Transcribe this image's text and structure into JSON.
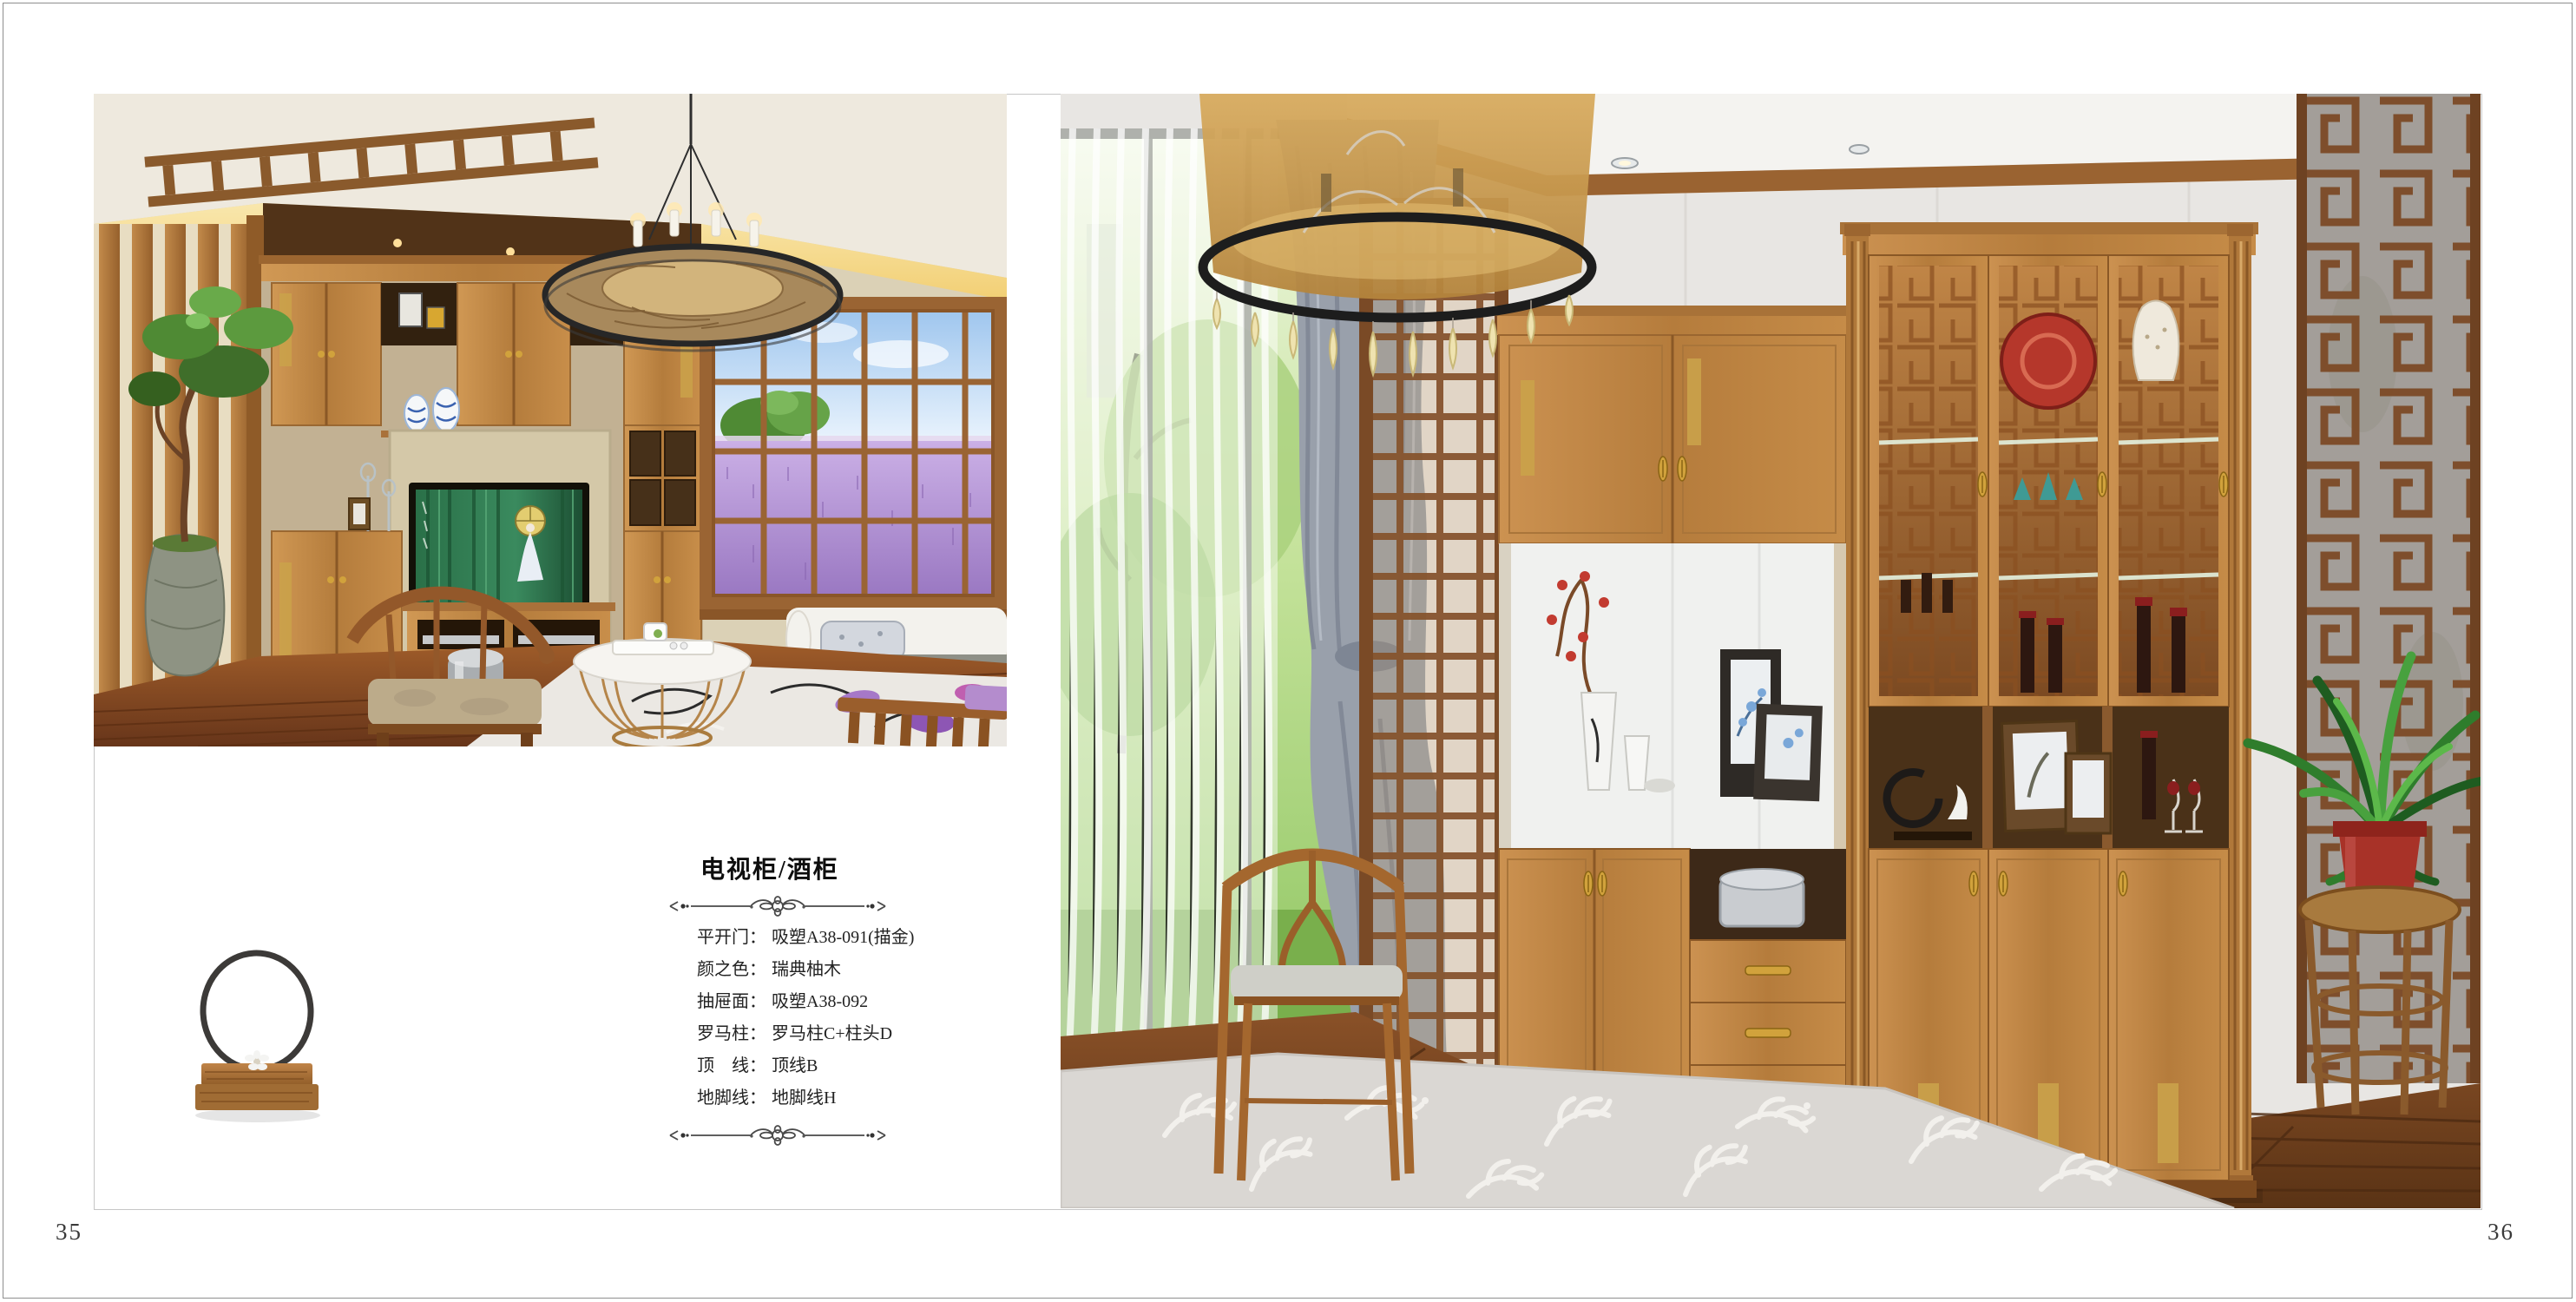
{
  "page": {
    "left_number": "35",
    "right_number": "36"
  },
  "product_info": {
    "title": "电视柜/酒柜",
    "specs": [
      {
        "label": "平开门：",
        "value": "吸塑A38-091(描金)"
      },
      {
        "label": "颜之色：",
        "value": "瑞典柚木"
      },
      {
        "label": "抽屉面：",
        "value": "吸塑A38-092"
      },
      {
        "label": "罗马柱：",
        "value": "罗马柱C+柱头D"
      },
      {
        "label": "顶　线：",
        "value": "顶线B"
      },
      {
        "label": "地脚线：",
        "value": "地脚线H"
      }
    ]
  },
  "photos": {
    "left_alt": "TV cabinet living-room scene",
    "right_alt": "Wine cabinet living-room scene",
    "decor_alt": "Ring ornament on wood base"
  },
  "colors": {
    "wood": "#bf8548",
    "wood_dark": "#8f5c28",
    "floor": "#7a4322",
    "accent_gold": "#caa24a",
    "lavender": "#b493d6",
    "cove_glow": "#f3cf74",
    "page_bg": "#ffffff"
  }
}
